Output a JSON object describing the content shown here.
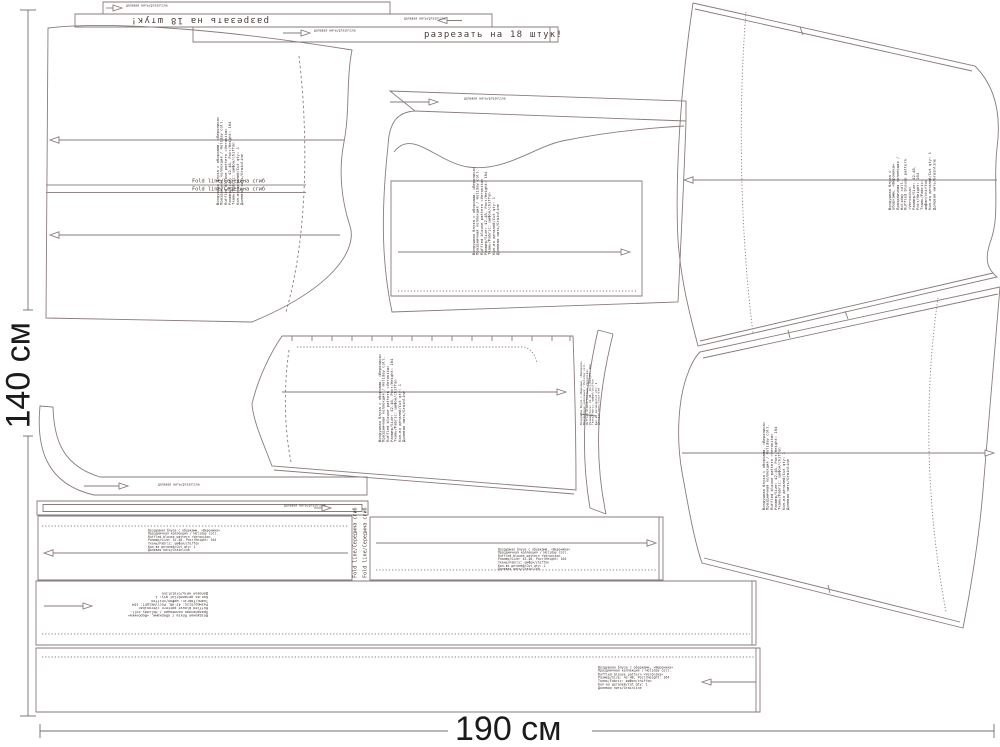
{
  "dimensions": {
    "height_label": "140 см",
    "width_label": "190 см"
  },
  "notes": {
    "cut_strip": "разрезать на 18 штук!",
    "fold_line": "Fold line/Середина сгиб",
    "grain": "долевая нить/grainline"
  },
  "piece_label": "Воздушная блуза с оборками, «Вероника»\nПраздничная коллекция / Holiday coll.\nRuffled blouse pattern «Veronika»\nРазмер/Size: 42-48, Рост/Height: 164\nТкань/Fabric: шифон/chiffon\nКол-во деталей/Cut qty: 1\nДолевая нить/Grainline",
  "colors": {
    "line": "#8a7b7b",
    "text": "#4a3f3f",
    "dim": "#1b1b1b",
    "bg": "#ffffff"
  }
}
